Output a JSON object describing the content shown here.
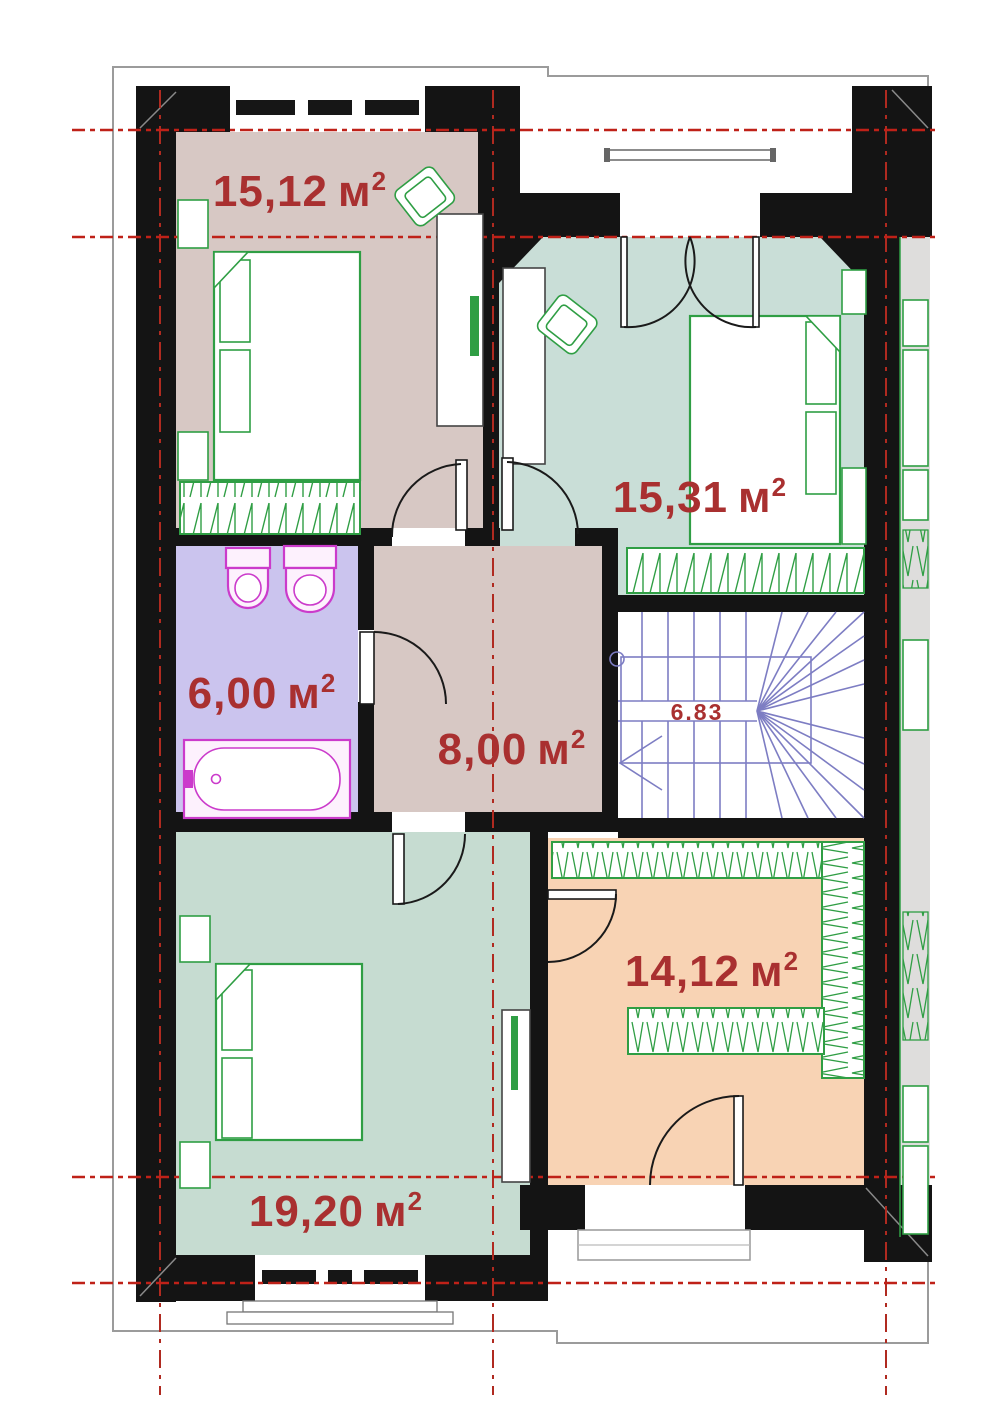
{
  "rooms": [
    {
      "id": "bedroom-top-left",
      "area": "15,12",
      "unit": "м",
      "power": "2",
      "fill": "#d7c8c4"
    },
    {
      "id": "bedroom-top-right",
      "area": "15,31",
      "unit": "м",
      "power": "2",
      "fill": "#c9ded7"
    },
    {
      "id": "bathroom",
      "area": "6,00",
      "unit": "м",
      "power": "2",
      "fill": "#cbc4ee"
    },
    {
      "id": "hallway",
      "area": "8,00",
      "unit": "м",
      "power": "2",
      "fill": "#d7c8c4"
    },
    {
      "id": "staircase",
      "area": "6.83",
      "unit": "",
      "power": "",
      "fill": "#ffffff"
    },
    {
      "id": "bedroom-bottom-left",
      "area": "19,20",
      "unit": "м",
      "power": "2",
      "fill": "#c6dcd1"
    },
    {
      "id": "dressing-room",
      "area": "14,12",
      "unit": "м",
      "power": "2",
      "fill": "#f8d3b4"
    }
  ],
  "colors": {
    "wall": "#141414",
    "label_text": "#a93030",
    "axis_line_red": "#bf2118",
    "furniture_green": "#2f9e44",
    "plumbing_magenta": "#cb3bcb",
    "stairs_blue": "#7d7dc3",
    "eaves_gray": "#9b9b9b",
    "neighbor_fill": "#dedddc",
    "desk_outline": "#444444"
  }
}
